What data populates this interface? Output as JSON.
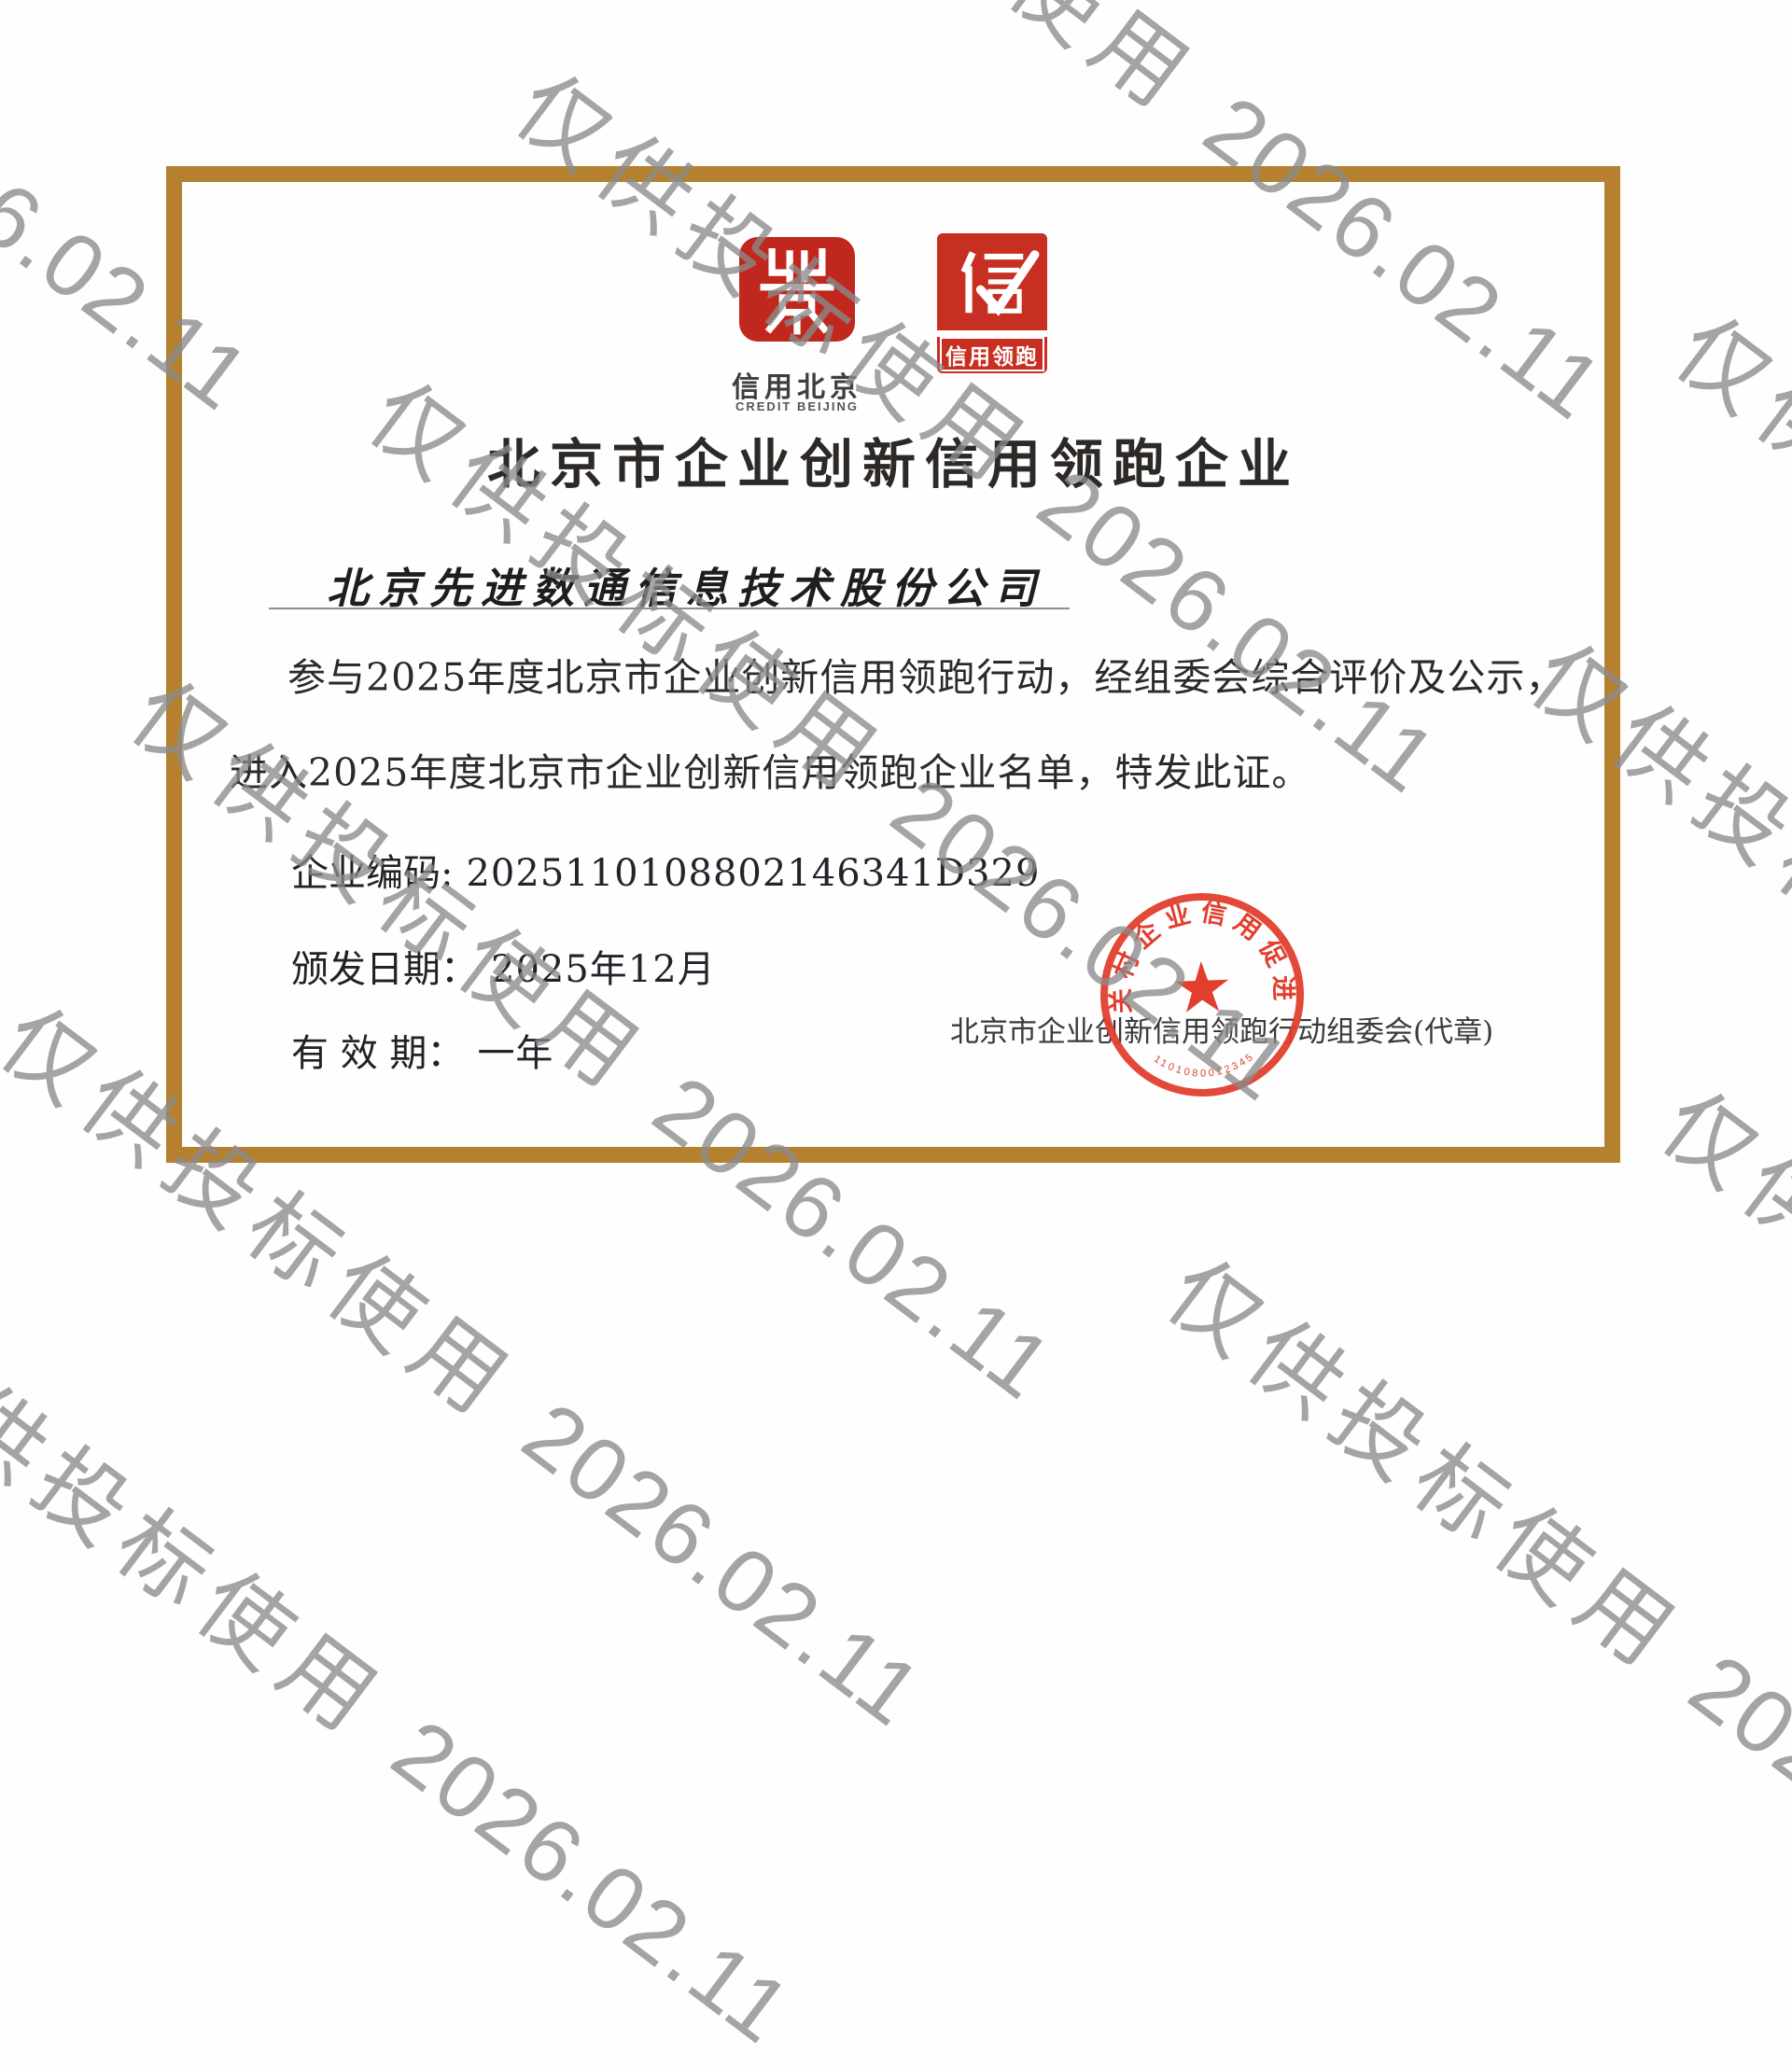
{
  "watermark": {
    "label": "仅供投标使用",
    "stamp": "2026.02.11"
  },
  "logos": {
    "credit_beijing": {
      "caption_zh": "信用北京",
      "caption_en": "CREDIT BEIJING"
    },
    "credit_leading": {
      "glyph": "信",
      "band": "信用领跑"
    }
  },
  "certificate": {
    "title": "北京市企业创新信用领跑企业",
    "company": "北京先进数通信息技术股份公司",
    "body_line1": "参与2025年度北京市企业创新信用领跑行动，经组委会综合评价及公示，",
    "body_line2": "进入2025年度北京市企业创新信用领跑企业名单，特发此证。",
    "fields": {
      "code_label": "企业编码:",
      "code_value": "2025110108802146341D329",
      "issue_label": "颁发日期：",
      "issue_value": "2025年12月",
      "valid_label": "有 效 期：",
      "valid_value": "一年"
    },
    "issuer": "北京市企业创新信用领跑行动组委会(代章)",
    "seal": {
      "arc_text": "中关村企业信用促进会",
      "serial": "1101080012345"
    },
    "colors": {
      "frame_gold": "#b5812f",
      "logo_red": "#c0281d",
      "seal_red": "#e23c2b",
      "watermark_gray": "#8a8a8a"
    }
  }
}
